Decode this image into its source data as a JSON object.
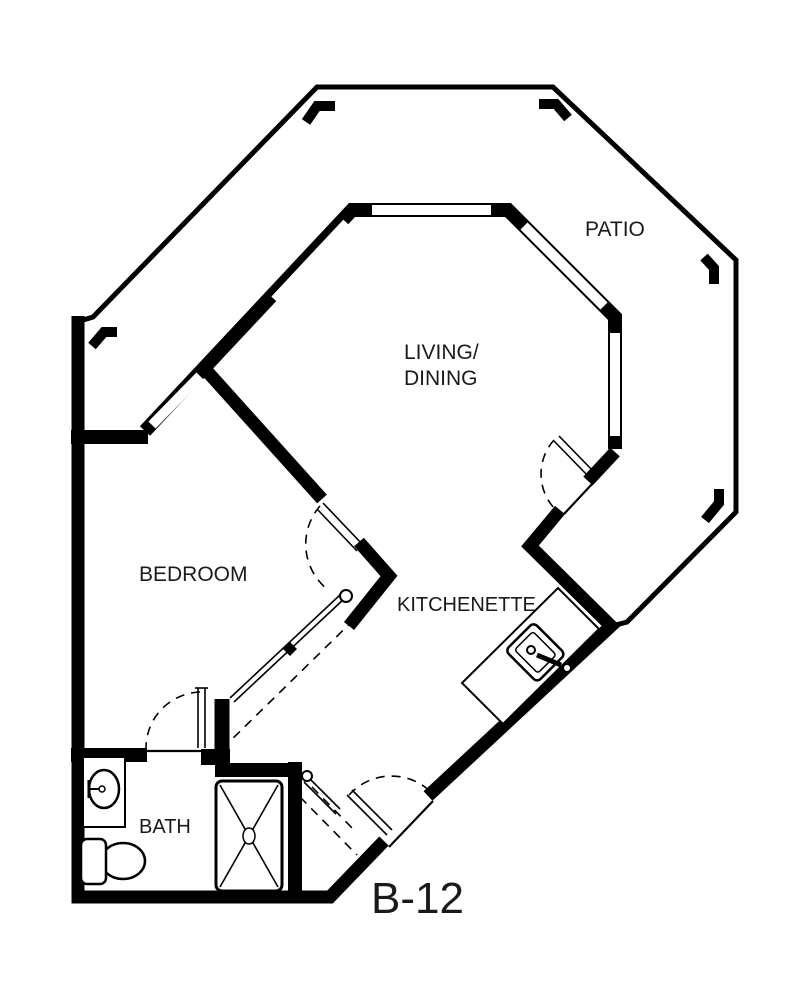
{
  "plan": {
    "unit_label": "B-12",
    "labels": {
      "patio": "PATIO",
      "living_line1": "LIVING/",
      "living_line2": "DINING",
      "bedroom": "BEDROOM",
      "kitchenette": "KITCHENETTE",
      "bath": "BATH"
    },
    "fixtures": {
      "bath_sink": "bathroom-sink",
      "toilet": "toilet",
      "shower": "shower",
      "kitchen_sink": "kitchen-sink",
      "kitchen_counter": "kitchen-counter"
    },
    "colors": {
      "line": "#000000",
      "background": "#ffffff"
    }
  }
}
